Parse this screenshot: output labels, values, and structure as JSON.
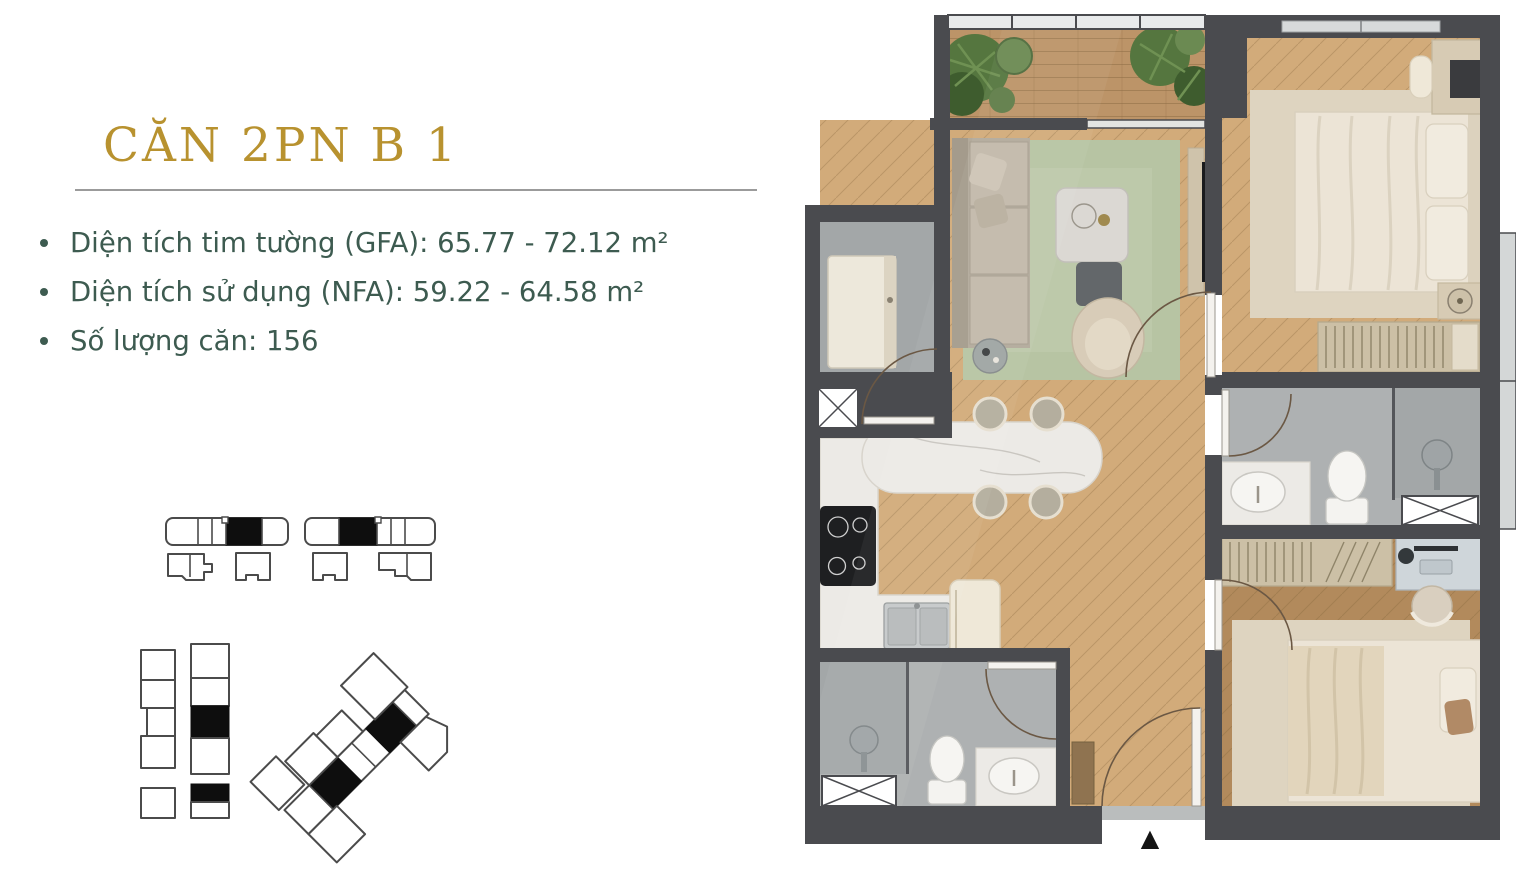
{
  "colors": {
    "wall": "#4A4B4F",
    "wood": "#D2AB7A",
    "wood-dark": "#BC9468",
    "wood-deep": "#B28A5C",
    "rug-green": "#B7C4A3",
    "rug-beige": "#DED4C0",
    "tile": "#AEB1B2",
    "tile-dark": "#A3A7A8",
    "marble": "#ECEAE6",
    "cream": "#EFE8D8",
    "sofa": "#B3AA9B",
    "sofa-cushion": "#C2B9AA",
    "bedding": "#ECE4D6",
    "plant": "#55763F",
    "plant-dark": "#3E5C2E",
    "glass": "#E8EAEB",
    "title-gold": "#B8922F",
    "text-teal": "#3D5B50",
    "arc": "#6B5844",
    "outline": "#4B4B4B"
  },
  "info": {
    "title": "CĂN 2PN B 1",
    "bullets": [
      "Diện tích tim tường (GFA): 65.77 - 72.12 m²",
      "Diện tích sử dụng (NFA): 59.22 - 64.58 m²",
      "Số lượng căn: 156"
    ]
  },
  "floor_plan": {
    "entry_marker": "▲"
  }
}
